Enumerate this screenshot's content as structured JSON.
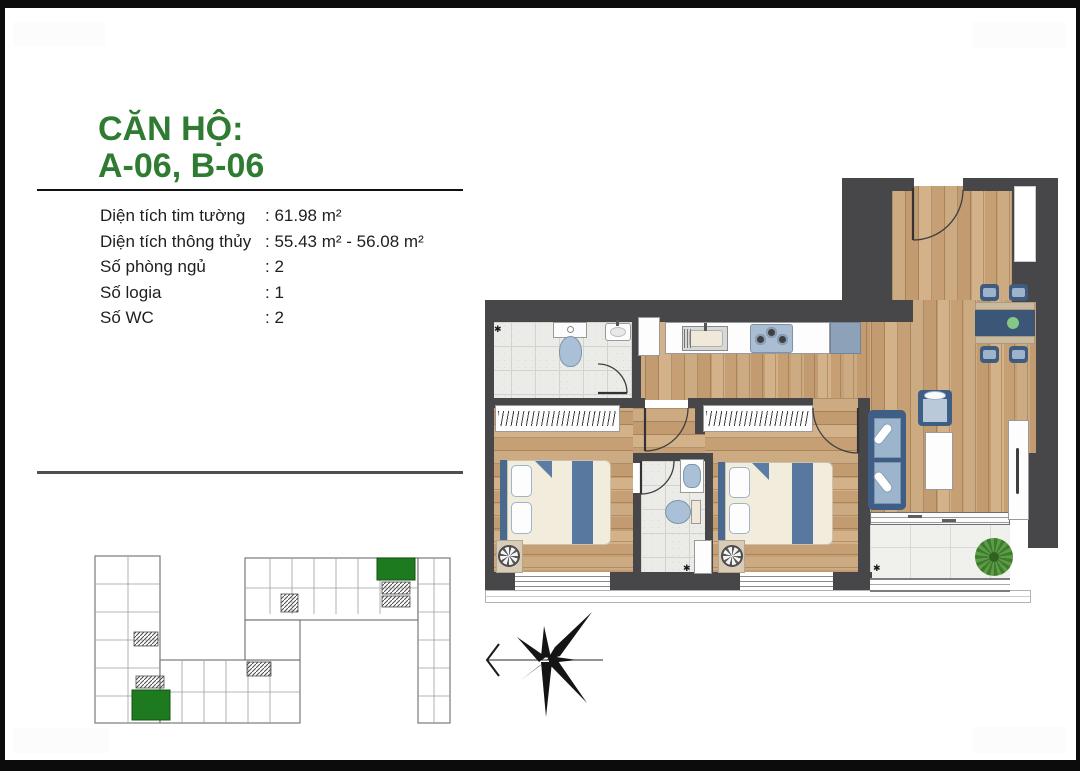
{
  "page": {
    "background": "#ffffff",
    "frame_color": "#0c0c0c"
  },
  "info": {
    "title_line1": "CĂN HỘ:",
    "title_line2": "A-06, B-06",
    "title_color": "#2e7b31",
    "specs": [
      {
        "label": "Diện tích tim tường",
        "value": ": 61.98 m²"
      },
      {
        "label": "Diện tích thông thủy",
        "value": ": 55.43 m² - 56.08 m²"
      },
      {
        "label": "Số phòng ngủ",
        "value": ": 2"
      },
      {
        "label": "Số logia",
        "value": ": 1"
      },
      {
        "label": "Số WC",
        "value": ": 2"
      }
    ]
  },
  "floor_plan": {
    "rooms": [
      "entry",
      "dining-area",
      "kitchen",
      "bathroom-1",
      "corridor",
      "bedroom-1",
      "bathroom-2",
      "bedroom-2",
      "living-area",
      "loggia"
    ],
    "colors": {
      "wall": "#47474a",
      "wood_floor": "#c8a377",
      "tile_floor": "#ebebe8",
      "furniture_blue_dark": "#3f5b7e",
      "furniture_blue_light": "#9db4cd",
      "cushion_cream": "#f2ecdc",
      "table_accent_green": "#86c687"
    }
  },
  "site_plan": {
    "highlight_color": "#1e7a1e",
    "highlighted_unit_count": 2,
    "line_color": "#7a7a7a"
  },
  "compass": {
    "style": "eight-point star with west pointer line",
    "color": "#141414"
  }
}
